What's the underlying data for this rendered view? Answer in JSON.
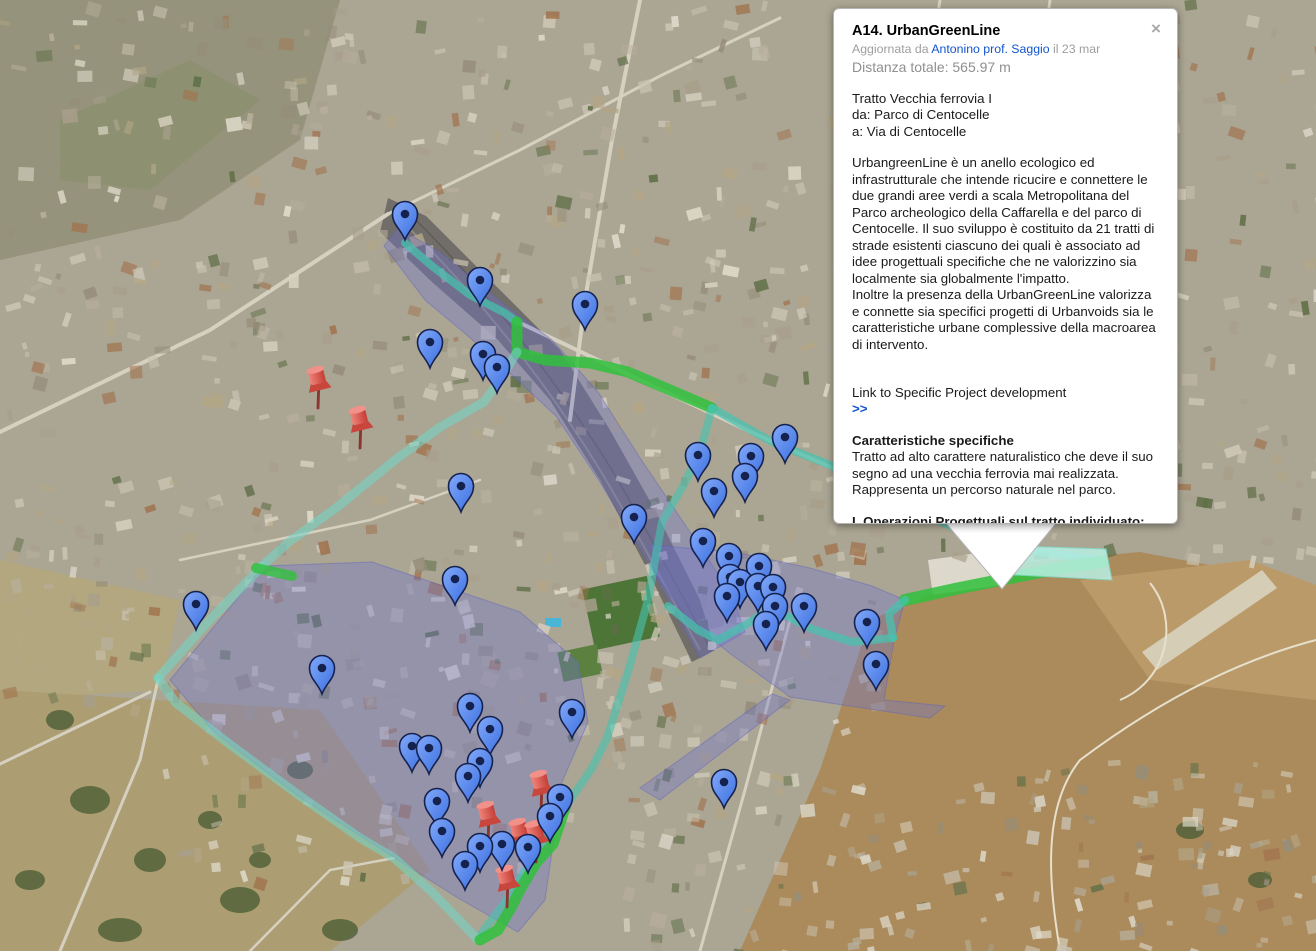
{
  "popup": {
    "title": "A14. UrbanGreenLine",
    "close_label": "×",
    "meta": {
      "prefix": "Aggiornata da",
      "author": "Antonino prof. Saggio",
      "suffix": "il 23 mar"
    },
    "distance": "Distanza totale: 565.97 m",
    "route_info": "Tratto Vecchia ferrovia I\nda: Parco di Centocelle\na: Via di Centocelle",
    "description": "UrbangreenLine è un anello ecologico ed infrastrutturale che intende ricucire e connettere le due grandi aree verdi a scala Metropolitana del Parco archeologico della Caffarella e del parco di Centocelle. Il suo sviluppo è costituito da 21 tratti di strade esistenti ciascuno dei quali è associato ad idee progettuali specifiche che ne valorizzino sia localmente sia globalmente l'impatto.\nInoltre la presenza della UrbanGreenLine valorizza e connette sia specifici progetti di Urbanvoids sia le caratteristiche urbane complessive della macroarea di intervento.",
    "link": {
      "text": "Link to Specific Project development",
      "arrows": ">>"
    },
    "section1": {
      "heading": "Caratteristiche specifiche",
      "body": "Tratto ad alto carattere naturalistico che deve il suo segno ad una vecchia ferrovia mai realizzata.\nRappresenta un percorso naturale nel parco."
    },
    "section2": {
      "heading": "I. Operazioni Progettuali sul tratto individuato:",
      "body": "Sistema tranviario, pista ciclabile, illuminazione informatizzata, totem informatizzati, orti urbani, piantumazione mirata, studio integrato della viabilità"
    }
  },
  "map": {
    "colors": {
      "route_teal": "#45c4b0",
      "route_teal_light": "#74d3c5",
      "route_green": "#2fc13c",
      "highlight": "#b9f0e4",
      "overlay_purple": "#6f74d0",
      "pin_blue_light": "#82a9f9",
      "pin_blue_dark": "#3b6fe0",
      "pin_outline": "#16224e",
      "pushpin_red": "#e0564c"
    },
    "highlight_polygon": [
      [
        988,
        545
      ],
      [
        1106,
        549
      ],
      [
        1112,
        580
      ],
      [
        996,
        574
      ]
    ],
    "overlays": [
      [
        [
          398,
          228
        ],
        [
          440,
          252
        ],
        [
          505,
          305
        ],
        [
          552,
          340
        ],
        [
          598,
          392
        ],
        [
          640,
          458
        ],
        [
          690,
          532
        ],
        [
          732,
          595
        ],
        [
          745,
          632
        ],
        [
          700,
          658
        ],
        [
          648,
          562
        ],
        [
          600,
          482
        ],
        [
          556,
          416
        ],
        [
          515,
          378
        ],
        [
          468,
          336
        ],
        [
          425,
          300
        ],
        [
          384,
          246
        ]
      ],
      [
        [
          170,
          680
        ],
        [
          264,
          566
        ],
        [
          372,
          562
        ],
        [
          520,
          612
        ],
        [
          578,
          662
        ],
        [
          588,
          722
        ],
        [
          562,
          782
        ],
        [
          545,
          900
        ],
        [
          518,
          932
        ],
        [
          458,
          898
        ],
        [
          395,
          858
        ],
        [
          298,
          796
        ],
        [
          214,
          732
        ]
      ],
      [
        [
          650,
          545
        ],
        [
          735,
          552
        ],
        [
          810,
          568
        ],
        [
          872,
          586
        ],
        [
          905,
          600
        ],
        [
          894,
          640
        ],
        [
          884,
          700
        ],
        [
          945,
          706
        ],
        [
          930,
          718
        ],
        [
          790,
          697
        ],
        [
          728,
          652
        ],
        [
          688,
          618
        ],
        [
          656,
          576
        ]
      ],
      [
        [
          772,
          694
        ],
        [
          790,
          700
        ],
        [
          660,
          800
        ],
        [
          640,
          788
        ]
      ]
    ],
    "routes": [
      {
        "color": "route_teal",
        "width": 8,
        "opacity": 0.72,
        "points": [
          [
            405,
            243
          ],
          [
            432,
            266
          ],
          [
            470,
            295
          ],
          [
            505,
            313
          ],
          [
            517,
            322
          ]
        ]
      },
      {
        "color": "route_green",
        "width": 11,
        "opacity": 0.85,
        "points": [
          [
            517,
            322
          ],
          [
            517,
            352
          ],
          [
            545,
            360
          ],
          [
            590,
            363
          ],
          [
            628,
            372
          ],
          [
            712,
            408
          ]
        ]
      },
      {
        "color": "route_teal",
        "width": 8,
        "opacity": 0.72,
        "points": [
          [
            712,
            408
          ],
          [
            772,
            442
          ],
          [
            830,
            465
          ],
          [
            880,
            492
          ],
          [
            930,
            516
          ],
          [
            980,
            540
          ],
          [
            1040,
            552
          ],
          [
            1100,
            560
          ]
        ]
      },
      {
        "color": "route_green",
        "width": 12,
        "opacity": 0.85,
        "points": [
          [
            905,
            600
          ],
          [
            955,
            589
          ],
          [
            1010,
            578
          ],
          [
            1060,
            568
          ],
          [
            1102,
            562
          ]
        ]
      },
      {
        "color": "route_teal",
        "width": 8,
        "opacity": 0.72,
        "points": [
          [
            905,
            600
          ],
          [
            889,
            614
          ],
          [
            893,
            638
          ]
        ]
      },
      {
        "color": "route_teal",
        "width": 8,
        "opacity": 0.72,
        "points": [
          [
            893,
            638
          ],
          [
            852,
            642
          ],
          [
            812,
            629
          ],
          [
            772,
            608
          ],
          [
            745,
            625
          ],
          [
            718,
            640
          ],
          [
            698,
            630
          ],
          [
            668,
            606
          ]
        ]
      },
      {
        "color": "route_teal",
        "width": 8,
        "opacity": 0.6,
        "points": [
          [
            712,
            408
          ],
          [
            700,
            452
          ],
          [
            682,
            488
          ],
          [
            662,
            522
          ],
          [
            655,
            560
          ],
          [
            648,
            600
          ],
          [
            628,
            672
          ],
          [
            607,
            738
          ],
          [
            592,
            768
          ],
          [
            566,
            806
          ],
          [
            534,
            856
          ],
          [
            505,
            902
          ],
          [
            481,
            934
          ]
        ]
      },
      {
        "color": "route_teal_light",
        "width": 9,
        "opacity": 0.6,
        "points": [
          [
            517,
            352
          ],
          [
            500,
            380
          ],
          [
            484,
            402
          ],
          [
            440,
            427
          ],
          [
            395,
            460
          ],
          [
            336,
            508
          ],
          [
            290,
            541
          ],
          [
            262,
            566
          ]
        ]
      },
      {
        "color": "route_teal_light",
        "width": 9,
        "opacity": 0.6,
        "points": [
          [
            262,
            566
          ],
          [
            208,
            622
          ],
          [
            158,
            678
          ]
        ]
      },
      {
        "color": "route_teal_light",
        "width": 9,
        "opacity": 0.6,
        "points": [
          [
            158,
            678
          ],
          [
            176,
            703
          ],
          [
            232,
            746
          ],
          [
            300,
            796
          ],
          [
            360,
            838
          ],
          [
            394,
            858
          ],
          [
            432,
            892
          ],
          [
            460,
            921
          ],
          [
            477,
            939
          ]
        ]
      },
      {
        "color": "route_green",
        "width": 11,
        "opacity": 0.85,
        "points": [
          [
            480,
            940
          ],
          [
            498,
            930
          ],
          [
            512,
            906
          ],
          [
            521,
            888
          ],
          [
            536,
            863
          ],
          [
            553,
            844
          ],
          [
            565,
            808
          ]
        ]
      },
      {
        "color": "route_green",
        "width": 10,
        "opacity": 0.8,
        "points": [
          [
            256,
            568
          ],
          [
            292,
            576
          ]
        ]
      }
    ],
    "pins_blue": [
      [
        405,
        240
      ],
      [
        480,
        306
      ],
      [
        585,
        330
      ],
      [
        430,
        368
      ],
      [
        483,
        380
      ],
      [
        497,
        393
      ],
      [
        461,
        512
      ],
      [
        698,
        481
      ],
      [
        785,
        463
      ],
      [
        751,
        482
      ],
      [
        745,
        502
      ],
      [
        714,
        517
      ],
      [
        634,
        543
      ],
      [
        703,
        567
      ],
      [
        729,
        582
      ],
      [
        759,
        592
      ],
      [
        730,
        603
      ],
      [
        740,
        608
      ],
      [
        758,
        612
      ],
      [
        773,
        613
      ],
      [
        727,
        622
      ],
      [
        775,
        632
      ],
      [
        804,
        632
      ],
      [
        766,
        650
      ],
      [
        867,
        648
      ],
      [
        876,
        690
      ],
      [
        724,
        808
      ],
      [
        196,
        630
      ],
      [
        322,
        694
      ],
      [
        455,
        605
      ],
      [
        470,
        732
      ],
      [
        490,
        755
      ],
      [
        572,
        738
      ],
      [
        412,
        772
      ],
      [
        429,
        774
      ],
      [
        480,
        787
      ],
      [
        468,
        802
      ],
      [
        437,
        827
      ],
      [
        560,
        823
      ],
      [
        550,
        842
      ],
      [
        442,
        857
      ],
      [
        480,
        872
      ],
      [
        502,
        870
      ],
      [
        528,
        873
      ],
      [
        465,
        890
      ]
    ],
    "pushpins_red": [
      [
        318,
        408
      ],
      [
        360,
        448
      ],
      [
        541,
        812
      ],
      [
        488,
        843
      ],
      [
        520,
        860
      ],
      [
        536,
        862
      ],
      [
        507,
        907
      ]
    ],
    "bubble_tail": [
      [
        944,
        521
      ],
      [
        1058,
        521
      ],
      [
        1002,
        589
      ]
    ]
  }
}
